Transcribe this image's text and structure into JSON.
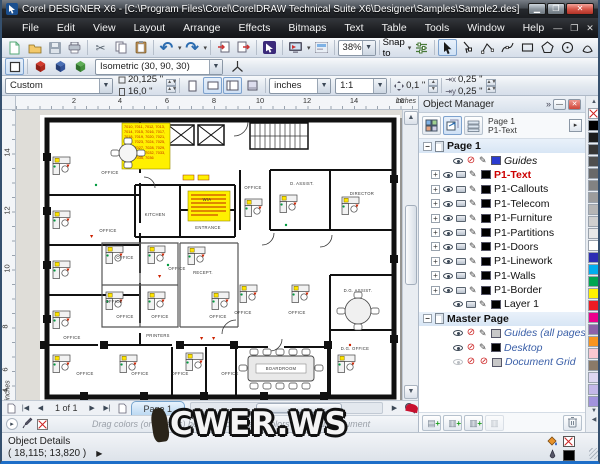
{
  "window": {
    "title": "Corel DESIGNER X6 - [C:\\Program Files\\Corel\\CorelDRAW Technical Suite X6\\Designer\\Samples\\Sample2.des]"
  },
  "menu": {
    "items": [
      "File",
      "Edit",
      "View",
      "Layout",
      "Arrange",
      "Effects",
      "Bitmaps",
      "Text",
      "Table",
      "Tools",
      "Window",
      "Help"
    ]
  },
  "toolbar": {
    "zoom_level": "38%",
    "snap_to_label": "Snap to"
  },
  "projection": {
    "preset": "Isometric (30, 90, 30)"
  },
  "property_bar": {
    "preset": "Custom",
    "page_width": "20,125 \"",
    "page_height": "16,0 \"",
    "units": "inches",
    "drawing_scale": "1:1",
    "nudge": "0,1 \"",
    "duplicate_x": "0,25 \"",
    "duplicate_y": "0,25 \""
  },
  "rulers": {
    "h_ticks": [
      "2",
      "4",
      "6",
      "8",
      "10",
      "12",
      "14",
      "16"
    ],
    "v_ticks": [
      "14",
      "12",
      "10",
      "8",
      "6",
      "4"
    ],
    "unit": "inches"
  },
  "object_manager": {
    "title": "Object Manager",
    "active_page": "Page 1",
    "active_layer": "P1-Text",
    "page1_label": "Page 1",
    "master_label": "Master Page",
    "layers": [
      {
        "name": "Guides",
        "chip": "#2a3bd0"
      },
      {
        "name": "P1-Text",
        "chip": "#000000"
      },
      {
        "name": "P1-Callouts",
        "chip": "#000000"
      },
      {
        "name": "P1-Telecom",
        "chip": "#000000"
      },
      {
        "name": "P1-Furniture",
        "chip": "#000000"
      },
      {
        "name": "P1-Partitions",
        "chip": "#000000"
      },
      {
        "name": "P1-Doors",
        "chip": "#000000"
      },
      {
        "name": "P1-Linework",
        "chip": "#000000"
      },
      {
        "name": "P1-Walls",
        "chip": "#000000"
      },
      {
        "name": "P1-Border",
        "chip": "#000000"
      },
      {
        "name": "Layer 1",
        "chip": "#000000"
      },
      {
        "name": "Guides (all pages)",
        "chip": "#c8c8c8"
      },
      {
        "name": "Desktop",
        "chip": "#000000"
      },
      {
        "name": "Document Grid",
        "chip": "#c8c8c8"
      }
    ]
  },
  "palette_colors": [
    "#000000",
    "#1c1c1c",
    "#363636",
    "#4f4f4f",
    "#696969",
    "#828282",
    "#9c9c9c",
    "#b5b5b5",
    "#cfcfcf",
    "#e8e8e8",
    "#ffffff",
    "#2d2db4",
    "#00adef",
    "#00a651",
    "#fff200",
    "#ed1c24",
    "#ec008c",
    "#8c62a8",
    "#f7941e",
    "#fac7d1",
    "#8a7a68",
    "#ded7f2",
    "#c3b8e8",
    "#a193dd"
  ],
  "nav": {
    "page_indicator": "1 of 1",
    "page_tab": "Page 1"
  },
  "doc_palette": {
    "hint": "Drag colors (or objects) here to store these colors with your document"
  },
  "status": {
    "label": "Object Details",
    "coords": "( 18,115; 13,820 )"
  },
  "watermark": "CWER.WS",
  "plan": {
    "callout1": "7010, 7011, 7012, 7013, 7014, 7015, 7016, 7017, 7018, 7019, 7020, 7021, 7022, 7023, 7024, 7025, 7026, 7027, 7028, 7029, 7030, 7031, 7032, 7033, 7034, 7035, 7036",
    "rooms": [
      "OFFICE",
      "OFFICE",
      "OFFICE",
      "OFFICE",
      "OFFICE",
      "OFFICE",
      "OFFICE",
      "OFFICE",
      "PRINTERS",
      "OFFICE",
      "OFFICE",
      "OFFICE",
      "OFFICE",
      "RECEPT.",
      "OFFICE",
      "KITCHEN",
      "WIA",
      "ENTRANCE",
      "OFFICE",
      "D. ASSIST.",
      "DIRECTOR",
      "OFFICE",
      "OFFICE",
      "D.G. ASSIST.",
      "D.G. OFFICE",
      "BOARDROOM"
    ]
  }
}
